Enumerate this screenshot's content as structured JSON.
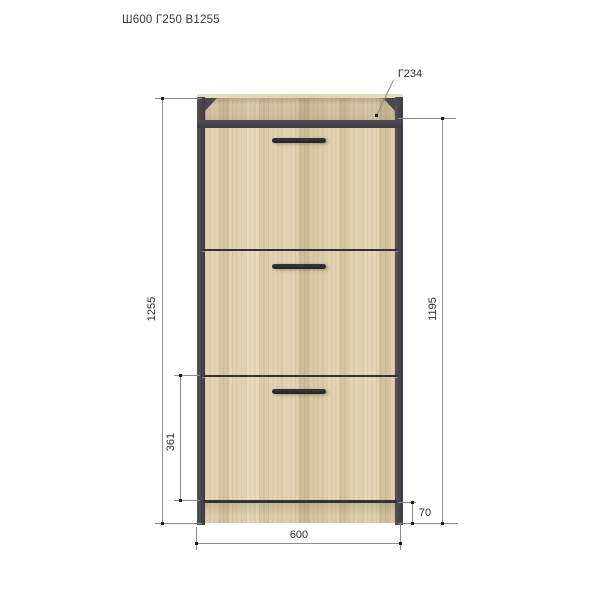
{
  "title": "Ш600 Г250 В1255",
  "dims": {
    "total_height": "1255",
    "front_height": "1195",
    "bottom_section_height": "361",
    "plinth_height": "70",
    "width": "600",
    "top_shelf_depth": "Г234"
  },
  "cabinet": {
    "door_count": 3,
    "style": "flip-down shoe cabinet, oak panels with graphite frame"
  },
  "colors": {
    "background": "#ffffff",
    "frame": "#4b4751",
    "wood_base": "#d9cba9",
    "dim_line": "#8c8c8c",
    "dim_text": "#2e2e2e",
    "handle": "#2b272d"
  }
}
